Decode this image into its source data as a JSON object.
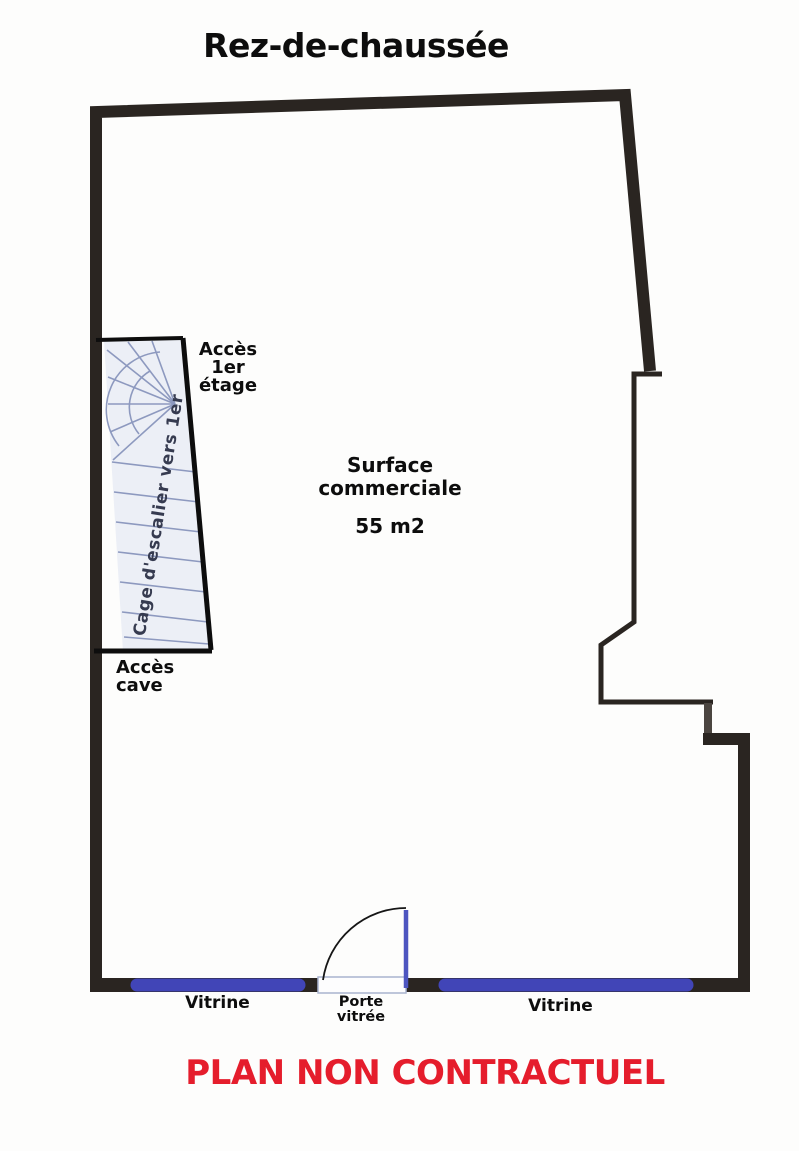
{
  "title": "Rez-de-chaussée",
  "plan": {
    "stairwell_label": "Cage d'escalier vers 1er",
    "access_first_floor": {
      "line1": "Accès",
      "line2": "1er étage"
    },
    "access_cellar": {
      "line1": "Accès",
      "line2": "cave"
    },
    "surface": {
      "line1": "Surface",
      "line2": "commerciale",
      "area": "55 m2"
    },
    "vitrine_left_label": "Vitrine",
    "door_label": {
      "line1": "Porte",
      "line2": "vitrée"
    },
    "vitrine_right_label": "Vitrine"
  },
  "footer": {
    "disclaimer": "PLAN NON CONTRACTUEL"
  },
  "colors": {
    "wall": "#2a2521",
    "vitrine_blue": "#4145b7",
    "door_blue": "#4d55c0",
    "stair_fill": "#eceff6",
    "stair_line": "#8d99bf",
    "threshold_border": "#a9b4cf",
    "accent_red": "#e51d2c",
    "ink": "#0d0d0d",
    "stair_text": "#363b50"
  }
}
